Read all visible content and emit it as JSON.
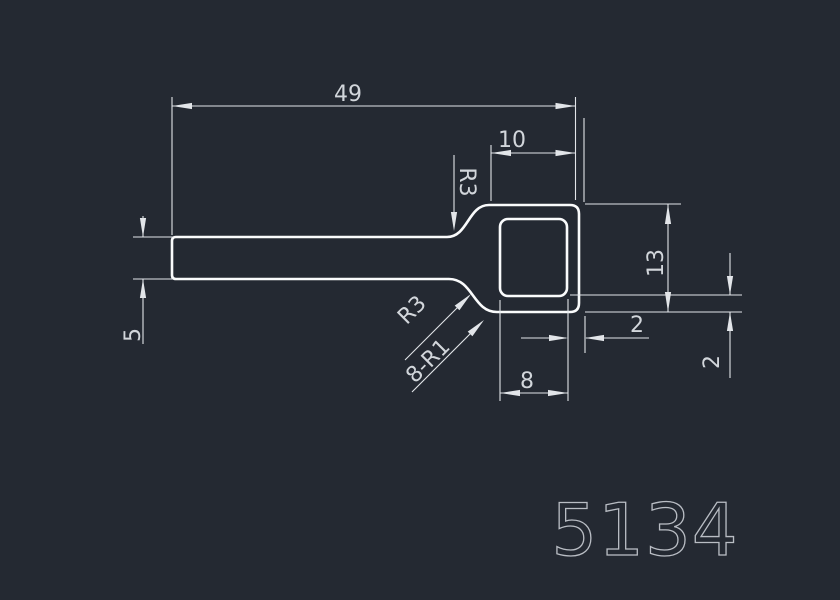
{
  "part_number": "5134",
  "colors": {
    "background": "#242932",
    "outline": "#fafbfc",
    "dimension_lines": "#e2e5e9",
    "dimension_text": "#d2d6db",
    "part_number_text": "#b9bdc4"
  },
  "dims": {
    "overall_length": {
      "label": "49"
    },
    "box_width": {
      "label": "10"
    },
    "box_height": {
      "label": "13"
    },
    "inner_width": {
      "label": "8"
    },
    "bar_thickness": {
      "label": "5"
    },
    "side_wall": {
      "label": "2"
    },
    "bottom_wall": {
      "label": "2"
    },
    "top_fillet": {
      "label": "R3"
    },
    "bottom_fillet": {
      "label": "R3"
    },
    "inner_corner_fillets": {
      "label": "8-R1"
    }
  }
}
